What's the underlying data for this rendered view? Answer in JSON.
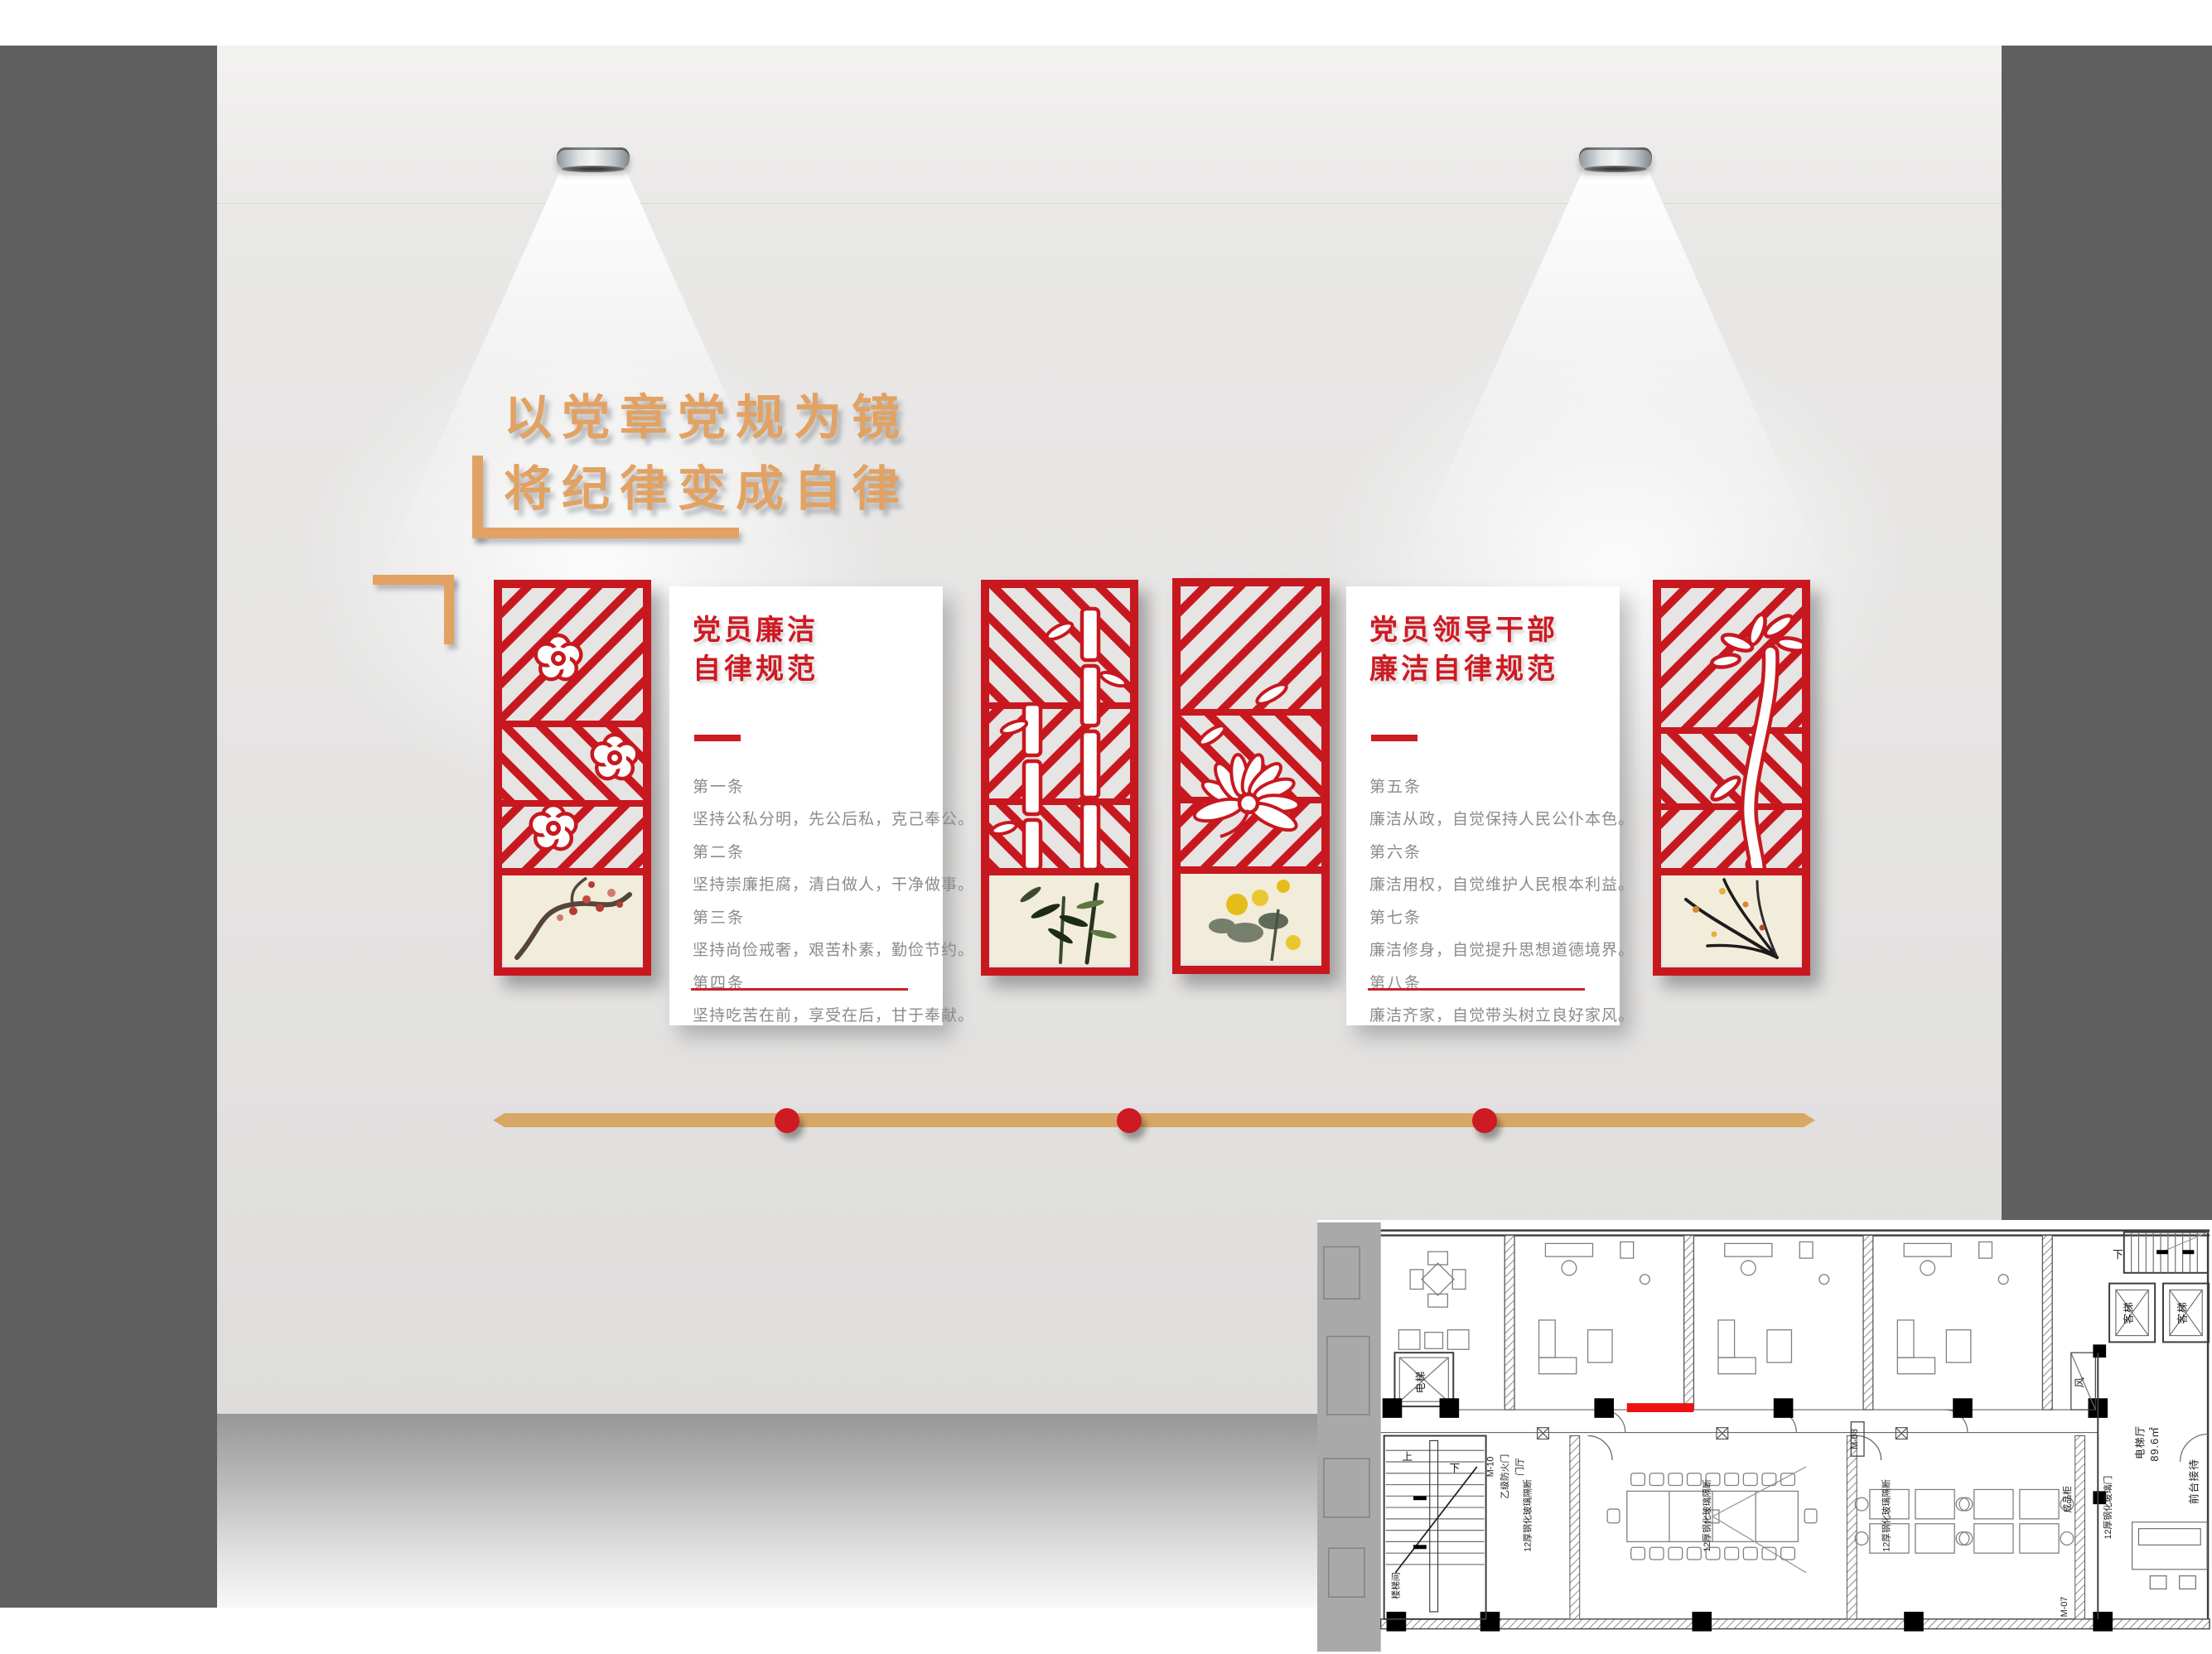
{
  "wall": {
    "headline": {
      "line1": "以党章党规为镜",
      "line2": "将纪律变成自律"
    },
    "colors": {
      "accent_gold": "#E1A263",
      "primary_red": "#C8181F",
      "cream": "#F2ECDB",
      "frame_gray": "#5F5F5F"
    },
    "rule_panels": [
      {
        "title_line1": "党员廉洁",
        "title_line2": "自律规范",
        "items": [
          {
            "no": "第一条",
            "text": "坚持公私分明，先公后私，克己奉公。"
          },
          {
            "no": "第二条",
            "text": "坚持崇廉拒腐，清白做人，干净做事。"
          },
          {
            "no": "第三条",
            "text": "坚持尚俭戒奢，艰苦朴素，勤俭节约。"
          },
          {
            "no": "第四条",
            "text": "坚持吃苦在前，享受在后，甘于奉献。"
          }
        ]
      },
      {
        "title_line1": "党员领导干部",
        "title_line2": "廉洁自律规范",
        "items": [
          {
            "no": "第五条",
            "text": "廉洁从政，自觉保持人民公仆本色。"
          },
          {
            "no": "第六条",
            "text": "廉洁用权，自觉维护人民根本利益。"
          },
          {
            "no": "第七条",
            "text": "廉洁修身，自觉提升思想道德境界。"
          },
          {
            "no": "第八条",
            "text": "廉洁齐家，自觉带头树立良好家风。"
          }
        ]
      }
    ],
    "lattice_panels": [
      {
        "id": "plum",
        "flower_icon": "plum-blossom-cutout",
        "painting_icon": "plum-ink-painting"
      },
      {
        "id": "bamboo",
        "flower_icon": "bamboo-cutout",
        "painting_icon": "bamboo-ink-painting"
      },
      {
        "id": "chrysanthemum",
        "flower_icon": "chrysanthemum-cutout",
        "painting_icon": "chrysanthemum-ink-painting"
      },
      {
        "id": "orchid",
        "flower_icon": "orchid-cutout",
        "painting_icon": "orchid-ink-painting"
      }
    ]
  },
  "floor_plan": {
    "elevator": "电梯",
    "up": "上",
    "down": "下",
    "door_m10": "M-10",
    "fire_door": "乙级防火门",
    "entry_hall": "门厅",
    "stairwell": "楼梯间",
    "glass_partition": "12厚钢化玻璃隔断",
    "glass_door": "12厚钢化玻璃门",
    "door_m08": "M-08",
    "door_m07": "M-07",
    "product_cabinet": "成品柜",
    "air_shaft": "风",
    "passenger_lift": "客梯",
    "lift_hall": "电梯厅",
    "lift_hall_area": "89.6㎡",
    "reception": "前台接待"
  }
}
